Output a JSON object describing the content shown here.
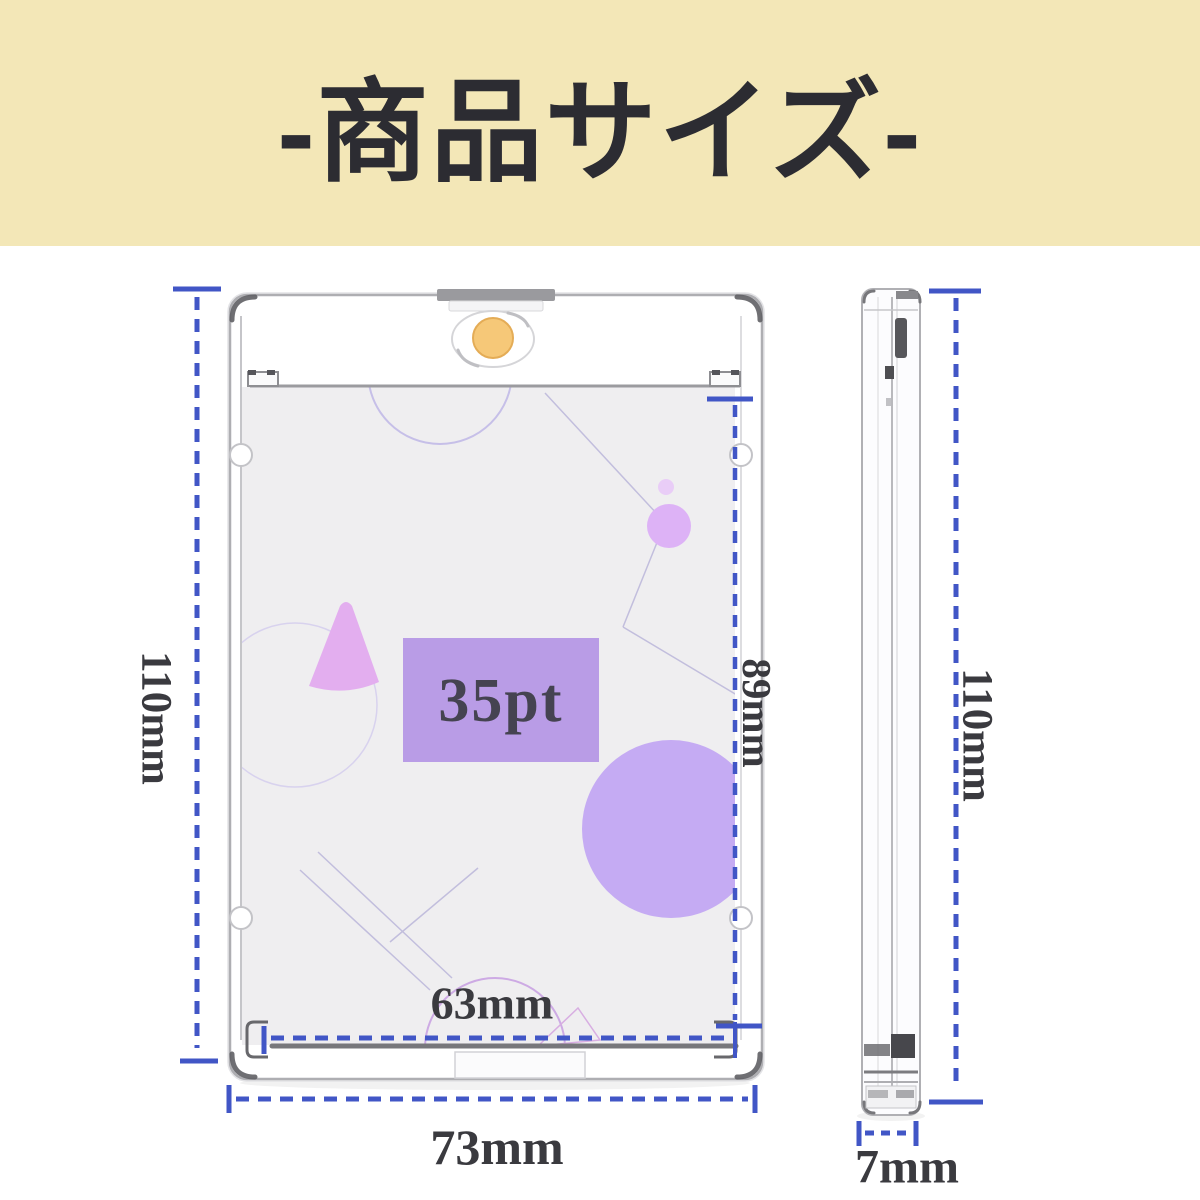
{
  "header": {
    "title": "-商品サイズ-"
  },
  "front_view": {
    "height_label": "110mm",
    "inner_height_label": "89mm",
    "inner_width_label": "63mm",
    "outer_width_label": "73mm",
    "thickness_rating": "35pt"
  },
  "side_view": {
    "height_label": "110mm",
    "thickness_label": "7mm"
  },
  "colors": {
    "header_bg": "#f3e7b7",
    "title_text": "#2c2c32",
    "dimension_blue": "#4156c6",
    "label_text": "#3a3a3f",
    "magnet_gold": "#f6c878",
    "magnet_gold_edge": "#e4ac56",
    "card_bg": "#efeef0",
    "pt_box_purple": "#b99ce6",
    "pt_text": "#454351",
    "big_circle_purple": "#c5abf3",
    "small_circle_purple": "#ddb2f6",
    "tiny_circle_purple": "#e9cdf7",
    "triangle_purple": "#e3aeef",
    "deco_line": "#c2bedd"
  }
}
